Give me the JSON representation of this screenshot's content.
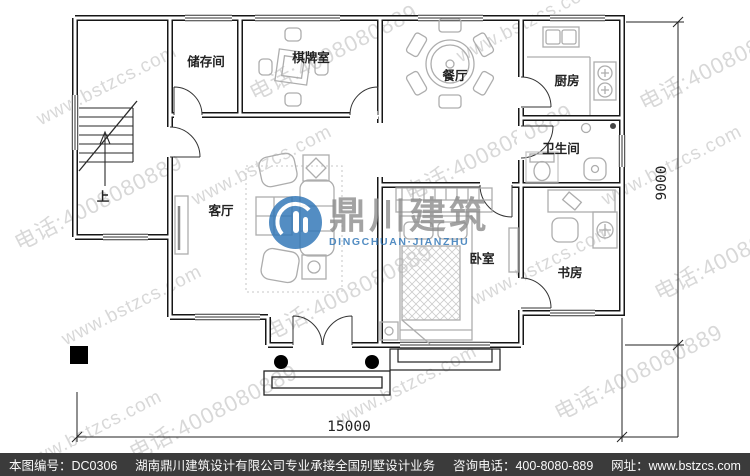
{
  "watermark": {
    "url": "www.bstzcs.com",
    "phone": "电话:4008080889"
  },
  "logo": {
    "name_cn": "鼎川建筑",
    "name_en": "DINGCHUAN·JIANZHU",
    "brand_color": "#2e75b6"
  },
  "plan": {
    "rooms": [
      {
        "id": "storage",
        "label": "储存间"
      },
      {
        "id": "game-room",
        "label": "棋牌室"
      },
      {
        "id": "dining-room",
        "label": "餐厅"
      },
      {
        "id": "kitchen",
        "label": "厨房"
      },
      {
        "id": "bathroom",
        "label": "卫生间"
      },
      {
        "id": "living-room",
        "label": "客厅"
      },
      {
        "id": "bedroom",
        "label": "卧室"
      },
      {
        "id": "study",
        "label": "书房"
      }
    ],
    "stairs_up_label": "上",
    "dimensions": {
      "width_mm": "15000",
      "height_mm": "9000"
    }
  },
  "footer": {
    "drawing_no": "本图编号：DC0306",
    "company": "湖南鼎川建筑设计有限公司专业承接全国别墅设计业务",
    "phone": "咨询电话：400-8080-889",
    "website": "网址：www.bstzcs.com"
  }
}
